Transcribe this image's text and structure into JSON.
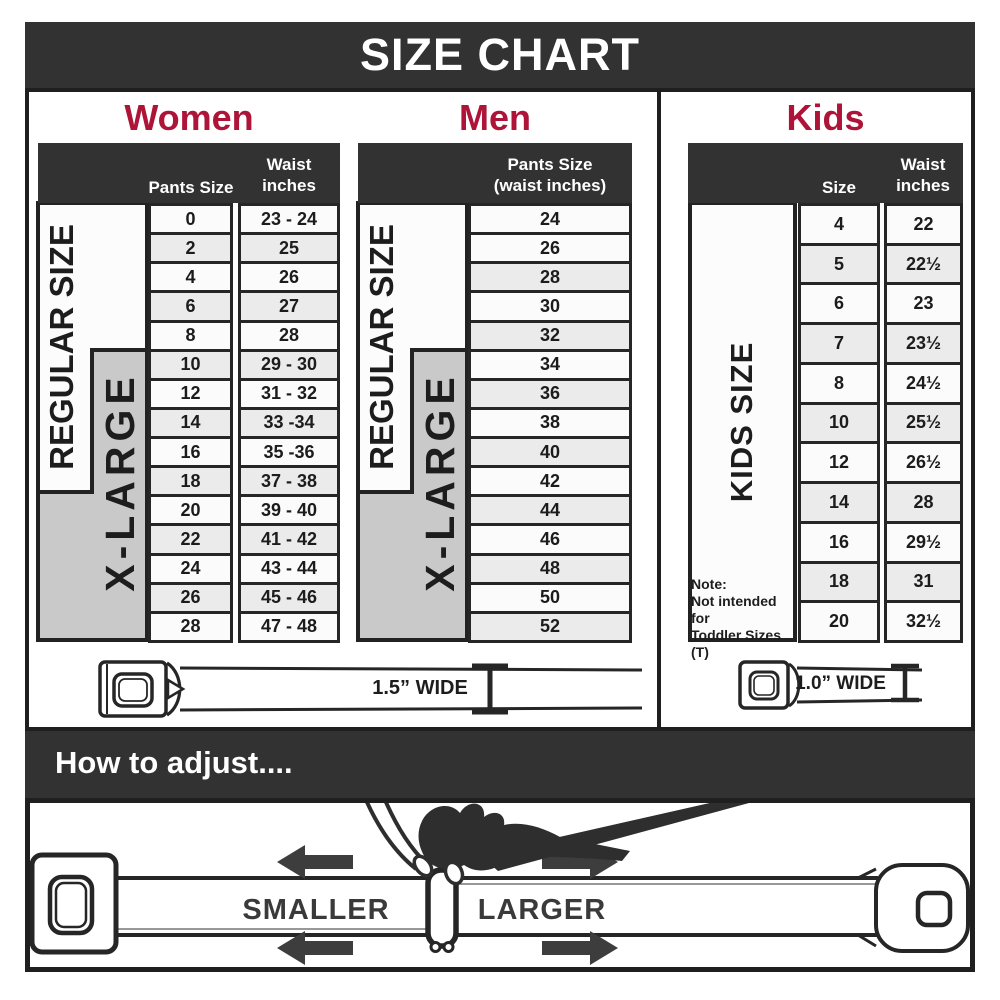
{
  "title": "SIZE CHART",
  "colors": {
    "accent_red": "#ae1338",
    "banner_bg": "#323232",
    "xlarge_gray": "#c9c9c9",
    "row_alt_gray": "#ebebeb"
  },
  "sections": {
    "women": {
      "title": "Women",
      "col1_header": "Pants Size",
      "col2_header_line1": "Waist",
      "col2_header_line2": "inches",
      "regular_label": "REGULAR SIZE",
      "xlarge_label": "X-LARGE",
      "rows": [
        [
          "0",
          "23 - 24"
        ],
        [
          "2",
          "25"
        ],
        [
          "4",
          "26"
        ],
        [
          "6",
          "27"
        ],
        [
          "8",
          "28"
        ],
        [
          "10",
          "29 - 30"
        ],
        [
          "12",
          "31 - 32"
        ],
        [
          "14",
          "33 -34"
        ],
        [
          "16",
          "35 -36"
        ],
        [
          "18",
          "37 - 38"
        ],
        [
          "20",
          "39 - 40"
        ],
        [
          "22",
          "41 - 42"
        ],
        [
          "24",
          "43 - 44"
        ],
        [
          "26",
          "45 - 46"
        ],
        [
          "28",
          "47 - 48"
        ]
      ]
    },
    "men": {
      "title": "Men",
      "header_line1": "Pants Size",
      "header_line2": "(waist inches)",
      "regular_label": "REGULAR SIZE",
      "xlarge_label": "X-LARGE",
      "rows": [
        "24",
        "26",
        "28",
        "30",
        "32",
        "34",
        "36",
        "38",
        "40",
        "42",
        "44",
        "46",
        "48",
        "50",
        "52"
      ]
    },
    "kids": {
      "title": "Kids",
      "col1_header": "Size",
      "col2_header_line1": "Waist",
      "col2_header_line2": "inches",
      "side_label": "KIDS SIZE",
      "note_line1": "Note:",
      "note_line2": "Not intended for",
      "note_line3": "Toddler Sizes (T)",
      "rows": [
        [
          "4",
          "22"
        ],
        [
          "5",
          "22½"
        ],
        [
          "6",
          "23"
        ],
        [
          "7",
          "23½"
        ],
        [
          "8",
          "24½"
        ],
        [
          "10",
          "25½"
        ],
        [
          "12",
          "26½"
        ],
        [
          "14",
          "28"
        ],
        [
          "16",
          "29½"
        ],
        [
          "18",
          "31"
        ],
        [
          "20",
          "32½"
        ]
      ]
    }
  },
  "belts": {
    "adult_width_label": "1.5” WIDE",
    "kids_width_label": "1.0” WIDE"
  },
  "adjust": {
    "heading": "How to adjust....",
    "smaller_label": "SMALLER",
    "larger_label": "LARGER"
  }
}
